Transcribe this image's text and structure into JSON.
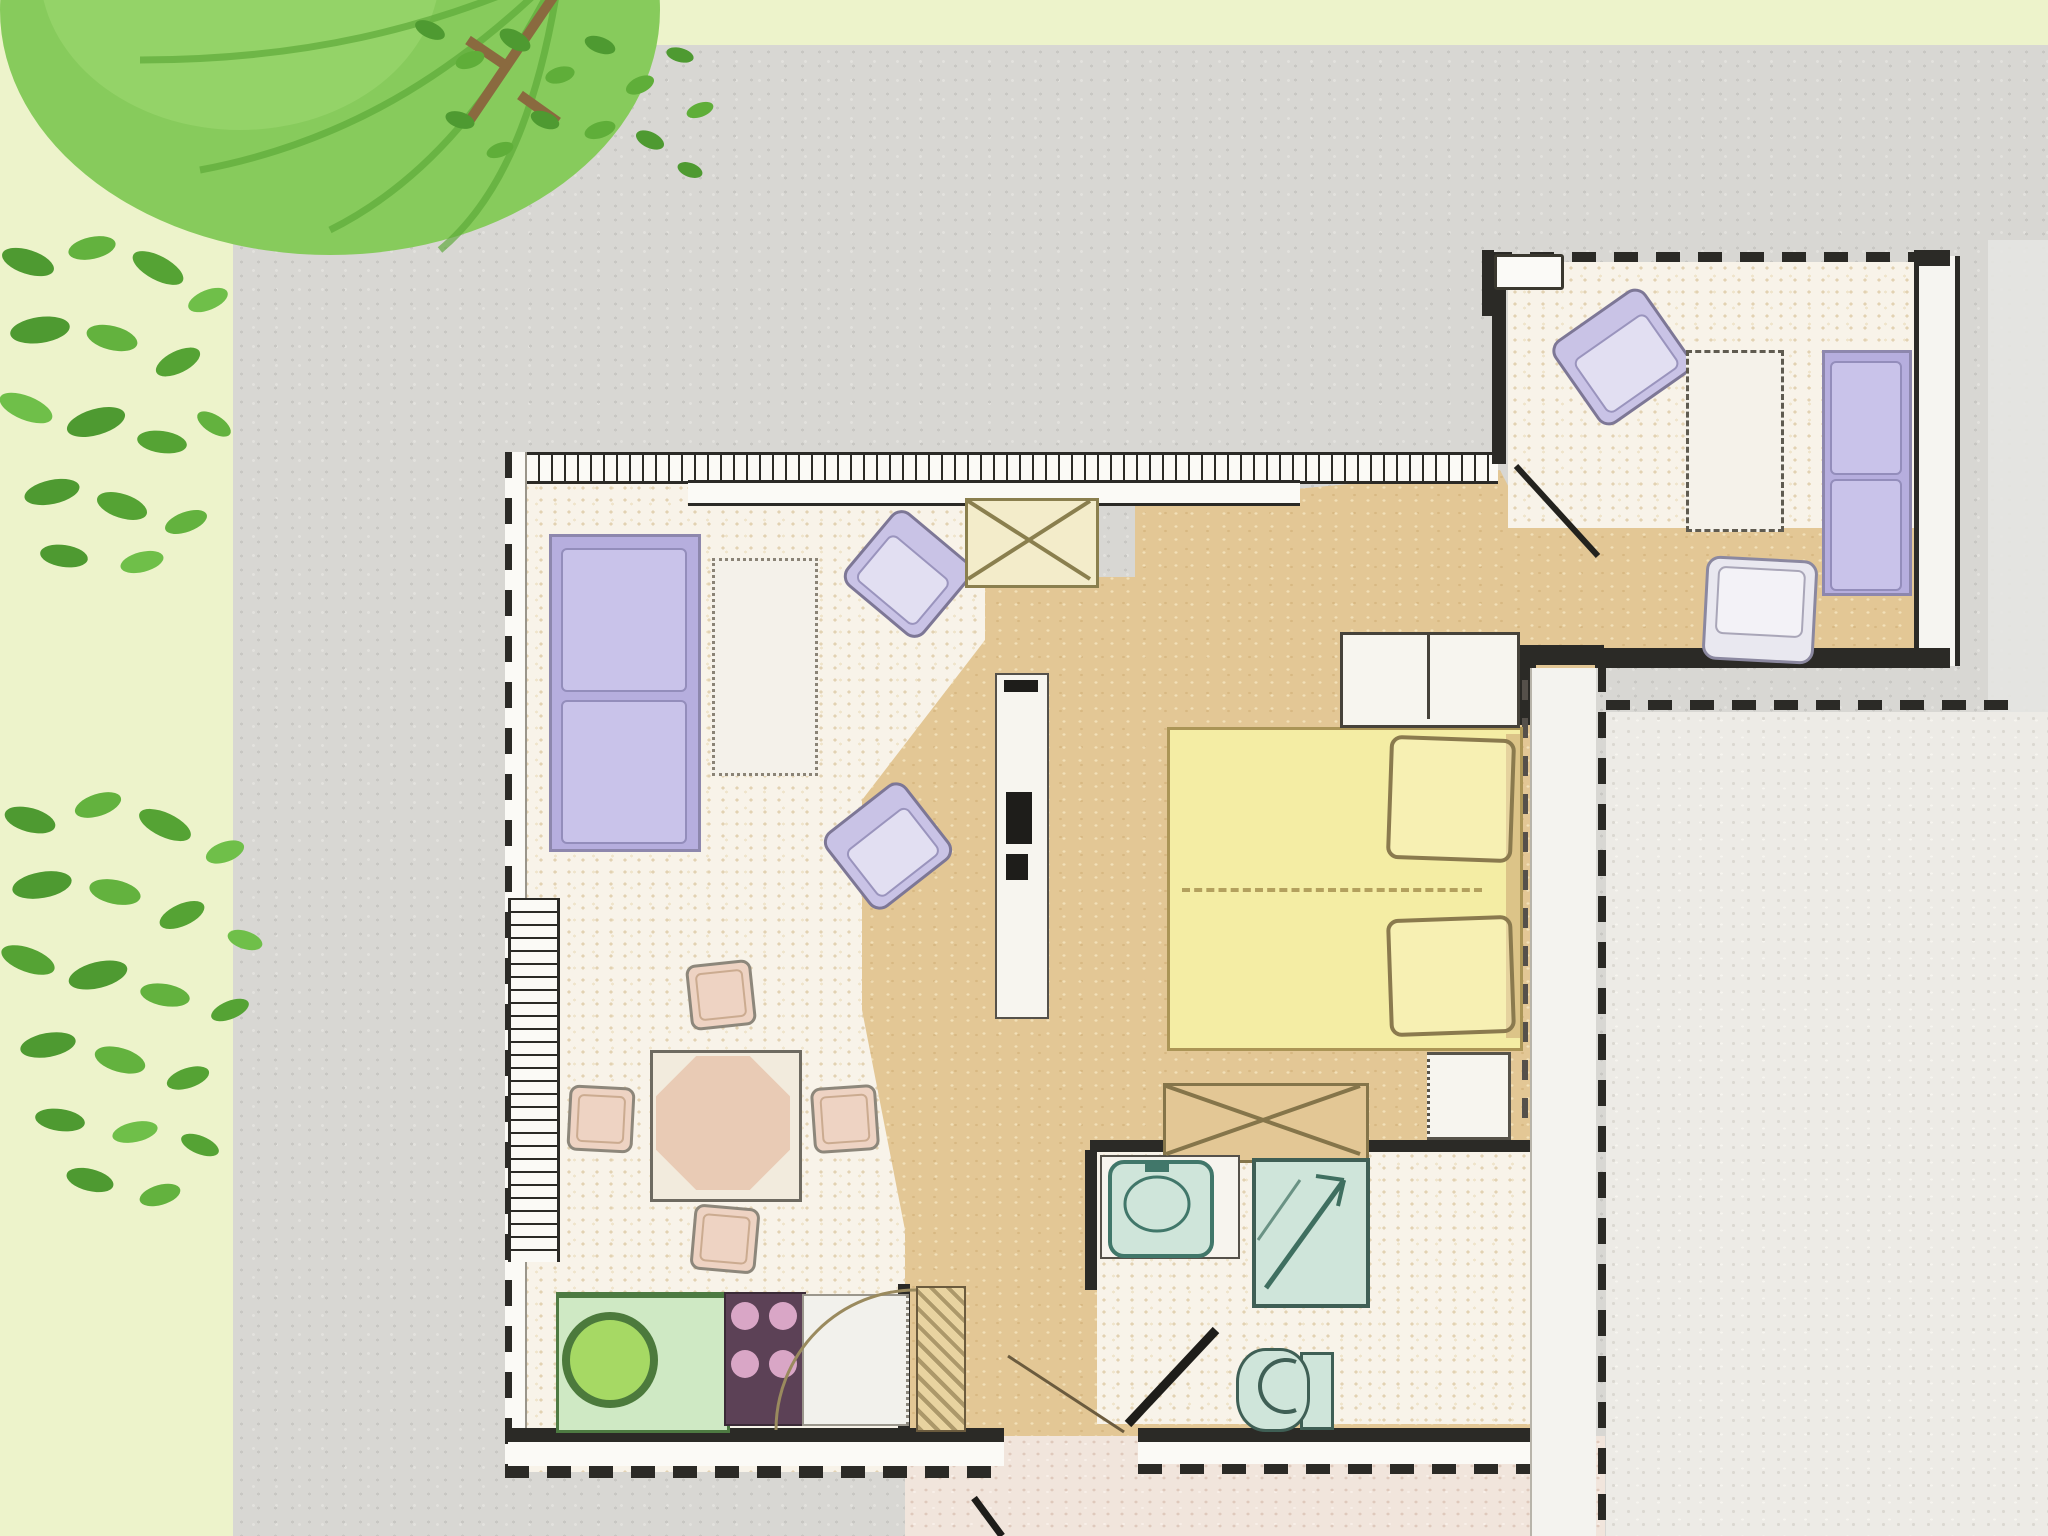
{
  "title": "Apartment floor plan with garden, courtyard and terrace",
  "image_kind": "architectural floor-plan illustration, top view, no text labels visible",
  "palette": {
    "garden_green": "#edf3cb",
    "foliage_light": "#87cb5c",
    "foliage_dark": "#4e9a31",
    "branch_brown": "#8a6a3f",
    "courtyard_gray": "#d8d7d3",
    "terrace_gray": "#edebe6",
    "room_floor_cream": "#f8f3e9",
    "hall_floor_tan": "#e3c795",
    "vestibule_pink": "#f1e5dc",
    "wall_black": "#2b2a26",
    "wall_white": "#f6f5f1",
    "sofa_purple": "#b6aede",
    "cushion_purple": "#c9c3ea",
    "armchair_lavender": "#c9c3e6",
    "bed_yellow": "#f4eda4",
    "bed_outline": "#ab9556",
    "bath_fixture_teal": "#cfe5da",
    "bath_line_teal": "#3f6f60",
    "kitchen_counter_green": "#cfe9c4",
    "sink_green": "#a6d964",
    "stove_plum": "#5c4156",
    "burner_pink": "#d9a6c6",
    "dining_wood": "#e9cbb5",
    "chair_blush": "#eed3c3",
    "cabinet_cream": "#f3ecca",
    "cabinet_line": "#8a7f4e"
  },
  "rooms": [
    {
      "id": "garden",
      "elements": [
        "tree-canopy",
        "shrub",
        "shrub"
      ]
    },
    {
      "id": "courtyard",
      "elements": [
        "paved-gray-area"
      ]
    },
    {
      "id": "living-area",
      "elements": [
        "two-seat-sofa",
        "coffee-table",
        "armchair",
        "armchair",
        "crossed-cabinet",
        "shelf-unit"
      ]
    },
    {
      "id": "dining-area",
      "elements": [
        "octagonal-table",
        "dining-chair",
        "dining-chair",
        "dining-chair",
        "dining-chair"
      ]
    },
    {
      "id": "kitchen",
      "elements": [
        "sink-counter",
        "stove",
        "worktop"
      ]
    },
    {
      "id": "bedroom",
      "elements": [
        "double-bed",
        "pillow",
        "pillow",
        "dresser",
        "nightstand",
        "blanket-chest"
      ]
    },
    {
      "id": "bathroom",
      "elements": [
        "washbasin",
        "shower",
        "toilet",
        "door-swing"
      ]
    },
    {
      "id": "entry-room",
      "elements": [
        "armchair",
        "side-table",
        "two-seat-sofa",
        "chair",
        "entry-door"
      ]
    },
    {
      "id": "hallway",
      "elements": [
        "interior-door",
        "entrance-opening",
        "door-swing"
      ]
    },
    {
      "id": "terrace",
      "elements": [
        "dashed-boundary"
      ]
    }
  ]
}
